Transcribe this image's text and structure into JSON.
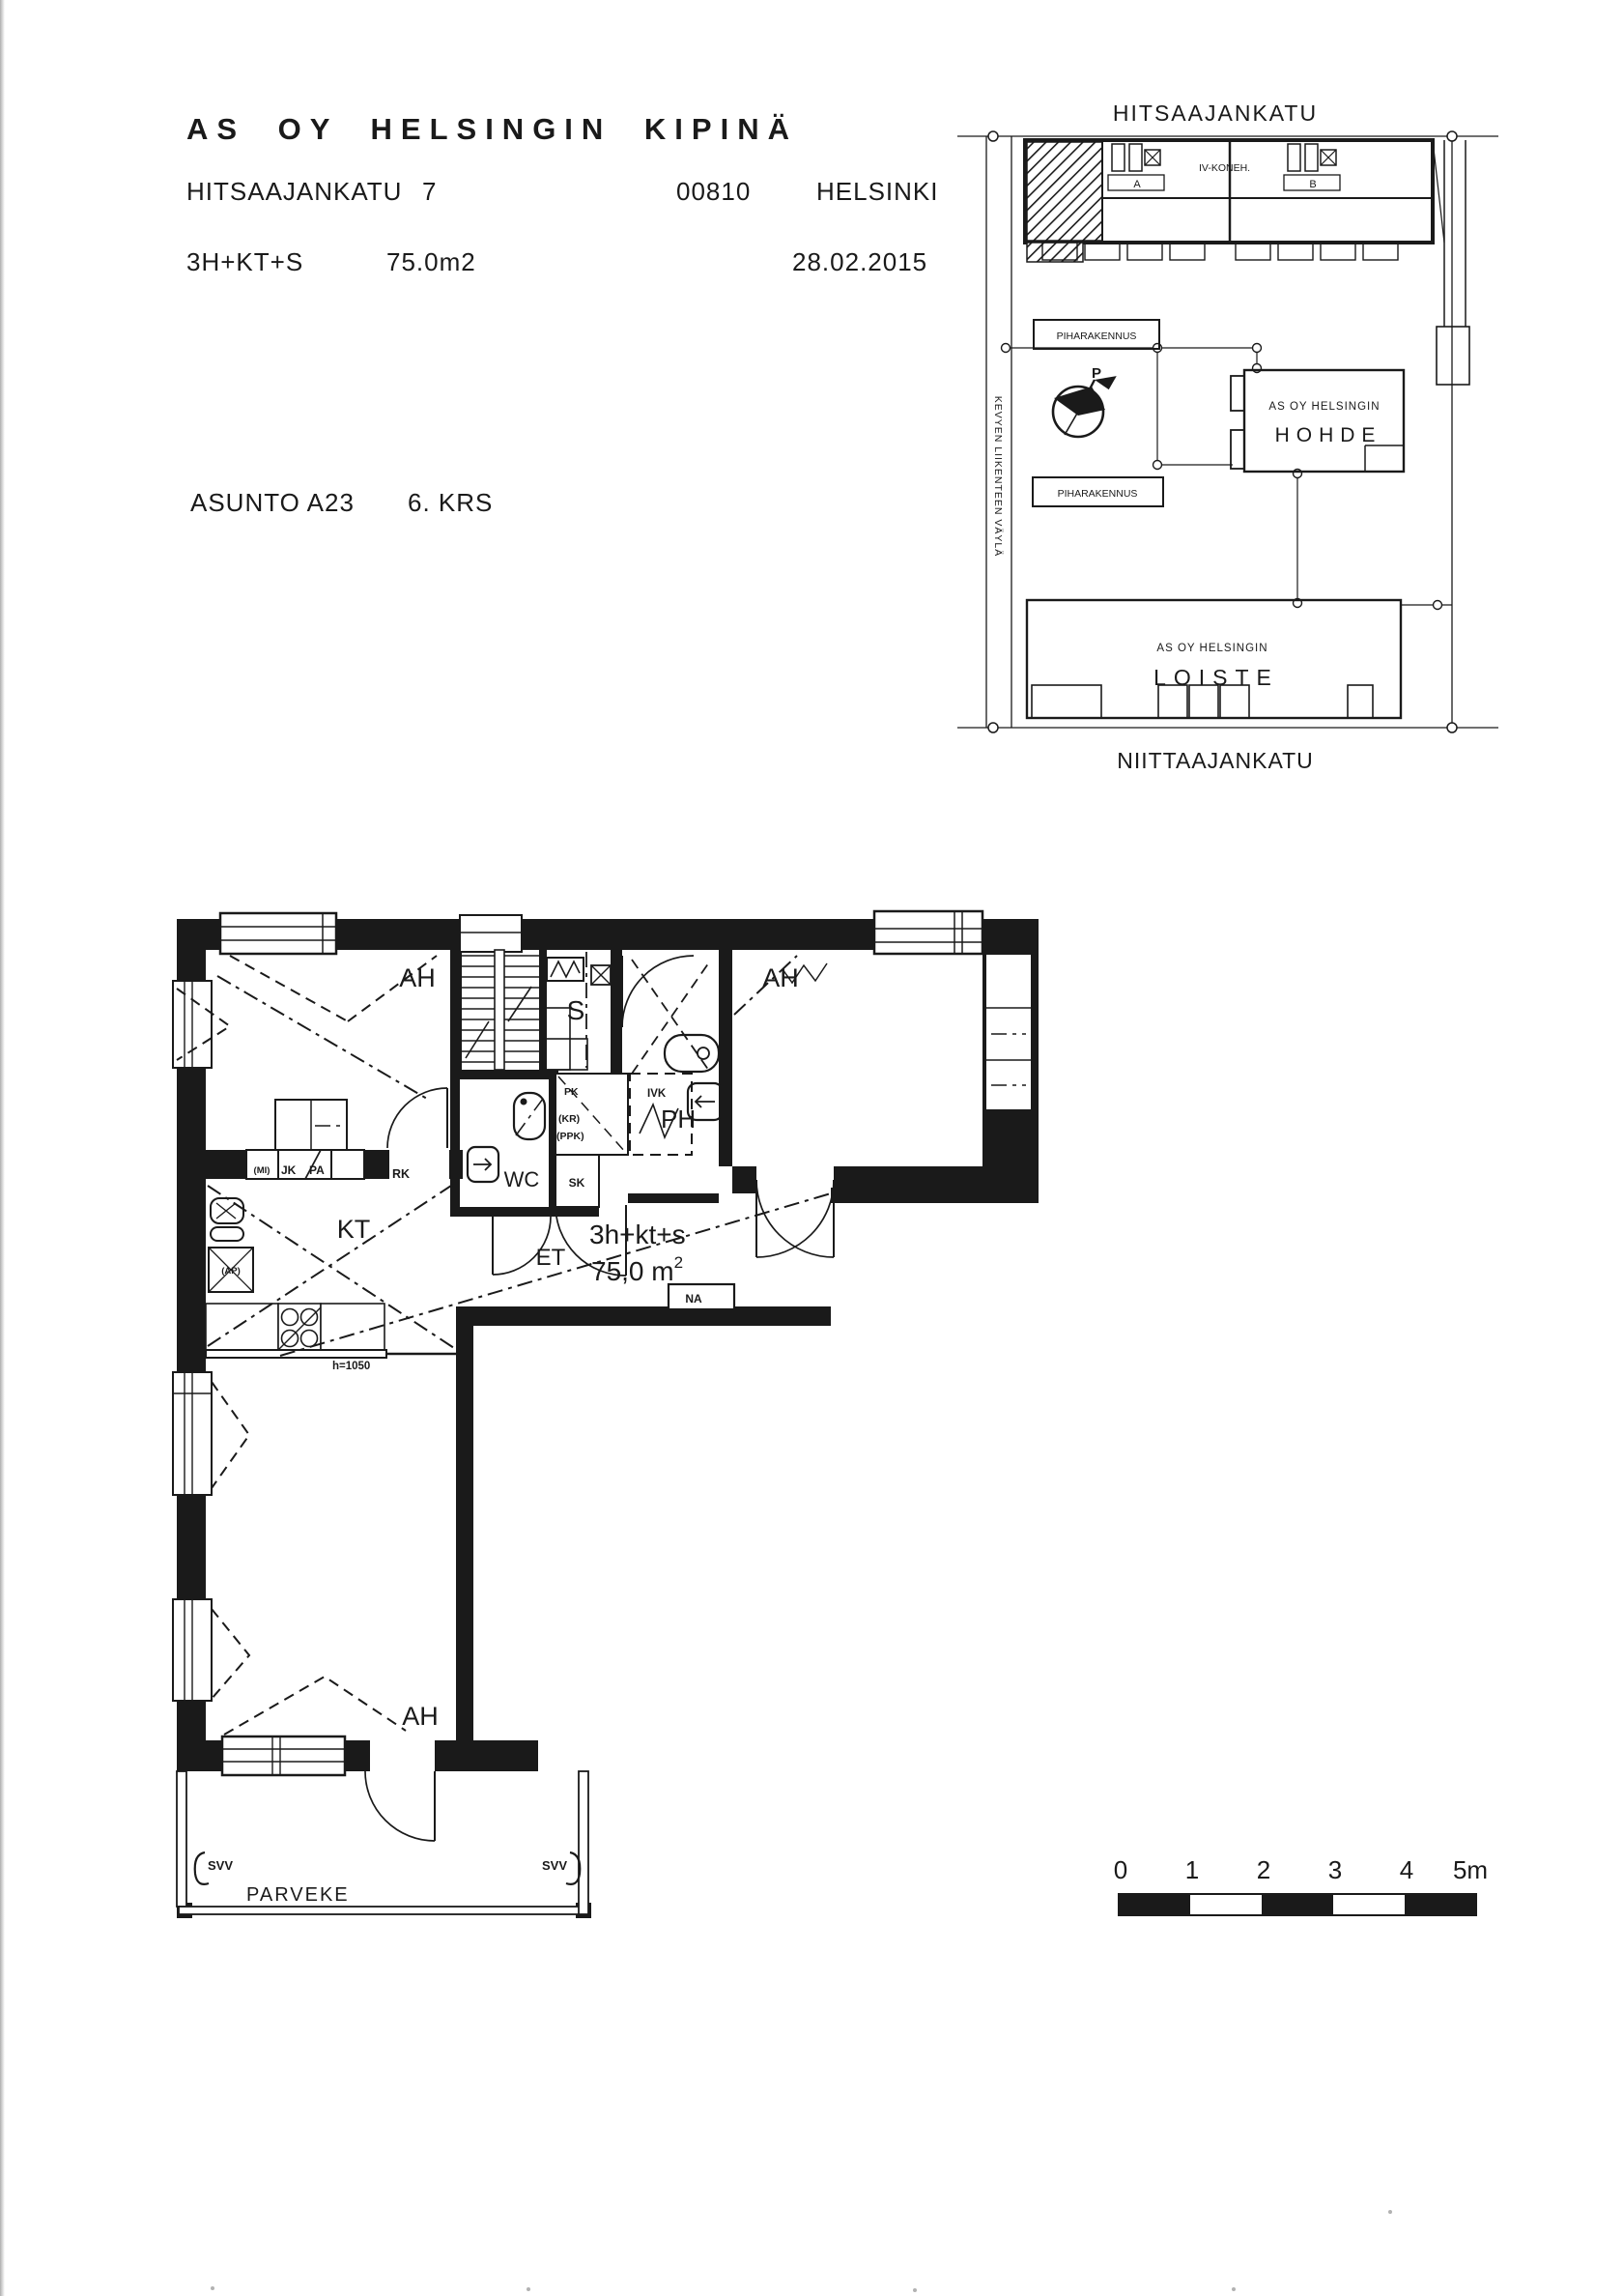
{
  "colors": {
    "ink": "#1a1a1a",
    "paper": "#ffffff"
  },
  "header": {
    "title": "AS OY HELSINGIN KIPINÄ",
    "street": "HITSAAJANKATU",
    "street_number": "7",
    "postal_code": "00810",
    "city": "HELSINKI",
    "apartment_type": "3H+KT+S",
    "area": "75.0m2",
    "date": "28.02.2015",
    "apartment": "ASUNTO A23",
    "floor": "6. KRS"
  },
  "site_plan": {
    "street_top": "HITSAAJANKATU",
    "street_bottom": "NIITTAAJANKATU",
    "lane_label": "KEVYEN LIIKENTEEN VÄYLÄ",
    "outbuilding": "PIHARAKENNUS",
    "iv_room": "IV-KONEH.",
    "stair_a": "A",
    "stair_b": "B",
    "compass": "P",
    "company_prefix": "AS OY HELSINGIN",
    "building_hohde": "HOHDE",
    "building_loiste": "LOISTE"
  },
  "floor_plan": {
    "labels": {
      "bedroom": "AH",
      "kitchen": "KT",
      "hall": "ET",
      "wc": "WC",
      "bathroom": "PH",
      "sauna": "S",
      "closet": "SK",
      "recess": "NA",
      "rk": "RK",
      "jk": "JK",
      "pa": "PA",
      "mi": "(MI)",
      "ap": "(AP)",
      "pk": "PK",
      "ivk": "IVK",
      "kr": "(KR)",
      "ppk": "(PPK)",
      "counter_height": "h=1050",
      "apartment_type": "3h+kt+s",
      "area": "75,0 m",
      "area_exp": "2",
      "balcony": "PARVEKE",
      "svv": "SVV"
    }
  },
  "scale_bar": {
    "ticks": [
      "0",
      "1",
      "2",
      "3",
      "4",
      "5m"
    ]
  }
}
